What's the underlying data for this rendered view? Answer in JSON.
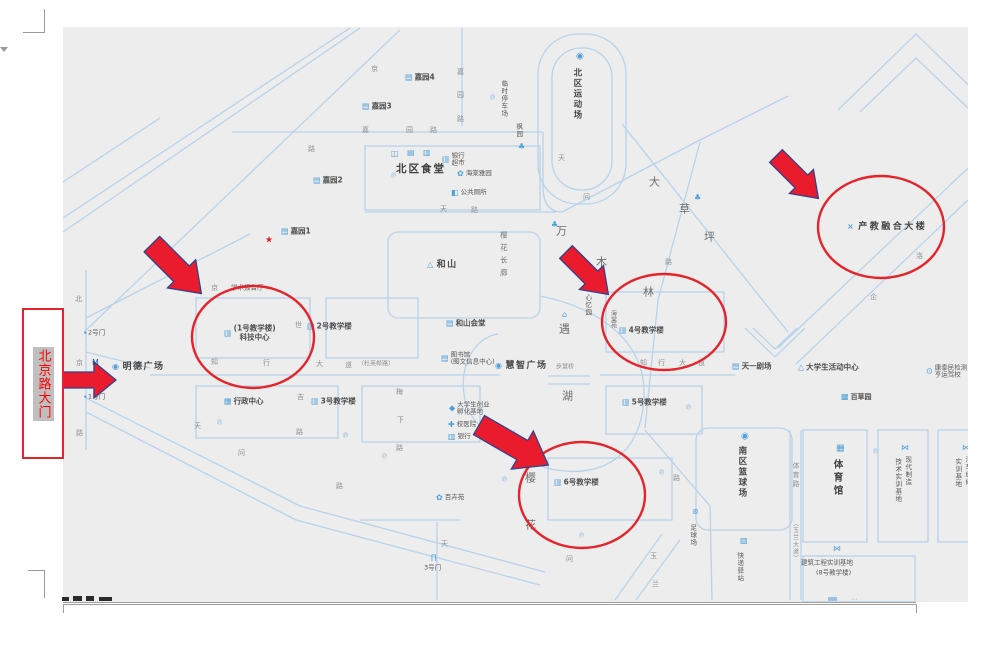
{
  "gate_box": {
    "text": "北京路大门",
    "text_color": "#ff0000",
    "border_color": "#e3242b",
    "highlight_color": "#bfbfbf"
  },
  "map": {
    "background": "#ededed",
    "road_color": "#b7d3ea",
    "icon_color": "#4fa0d9",
    "annotation_color": "#e5232b",
    "arrow_fill": "#ea1b2d",
    "arrow_stroke": "#334189",
    "labels": [
      {
        "t": "嘉园4",
        "x": 405,
        "y": 78,
        "k": "b",
        "i": "▤",
        "n": "jiayuan4-label"
      },
      {
        "t": "嘉园3",
        "x": 362,
        "y": 107,
        "k": "b",
        "i": "▤",
        "n": "jiayuan3-label"
      },
      {
        "t": "嘉园2",
        "x": 313,
        "y": 181,
        "k": "b",
        "i": "▤",
        "n": "jiayuan2-label"
      },
      {
        "t": "嘉园1",
        "x": 281,
        "y": 232,
        "k": "b",
        "i": "▤",
        "n": "jiayuan1-label"
      },
      {
        "i": "★",
        "x": 265,
        "y": 241,
        "s": 9,
        "ic": "#e02020",
        "n": "star-icon"
      },
      {
        "t": "北区食堂",
        "x": 396,
        "y": 169,
        "k": "bb",
        "n": "north-canteen-label"
      },
      {
        "i": "◫",
        "x": 391,
        "y": 154,
        "n": "canteen-icon"
      },
      {
        "i": "▤",
        "x": 407,
        "y": 153,
        "n": "canteen-icon"
      },
      {
        "i": "▥",
        "x": 423,
        "y": 153,
        "n": "canteen-icon"
      },
      {
        "l": [
          "银行",
          "超市"
        ],
        "x": 442,
        "y": 160,
        "k": "s2",
        "i": "▥",
        "n": "bank-store-label"
      },
      {
        "t": "海棠雅园",
        "x": 457,
        "y": 174,
        "k": "t",
        "i": "✿",
        "n": "haitang-garden-label"
      },
      {
        "t": "公共厕所",
        "x": 451,
        "y": 193,
        "k": "t",
        "i": "◧",
        "n": "public-toilet-label"
      },
      {
        "i": "℗",
        "x": 390,
        "y": 176,
        "s": 7,
        "ic": "#87b9de",
        "n": "parking-icon"
      },
      {
        "i": "℗",
        "x": 489,
        "y": 98,
        "s": 7,
        "ic": "#87b9de",
        "n": "parking-icon"
      },
      {
        "t": "临时停车场",
        "x": 503,
        "y": 80,
        "k": "tv",
        "v": true,
        "n": "temp-parking-label"
      },
      {
        "t": "枫园",
        "x": 518,
        "y": 123,
        "k": "tv",
        "v": true,
        "n": "fengyuan-label"
      },
      {
        "i": "♣",
        "x": 518,
        "y": 147,
        "n": "garden-icon"
      },
      {
        "i": "◉",
        "x": 576,
        "y": 57,
        "s": 9,
        "n": "stadium-icon"
      },
      {
        "t": "北区运动场",
        "x": 576,
        "y": 68,
        "k": "bv",
        "v": true,
        "n": "north-sports-field-label"
      },
      {
        "t": "嘉",
        "x": 457,
        "y": 72,
        "k": "r"
      },
      {
        "t": "园",
        "x": 457,
        "y": 95,
        "k": "r"
      },
      {
        "t": "路",
        "x": 457,
        "y": 119,
        "k": "r"
      },
      {
        "t": "京",
        "x": 371,
        "y": 69,
        "k": "r"
      },
      {
        "t": "嘉",
        "x": 362,
        "y": 130,
        "k": "r"
      },
      {
        "t": "园",
        "x": 406,
        "y": 130,
        "k": "r"
      },
      {
        "t": "路",
        "x": 430,
        "y": 130,
        "k": "r"
      },
      {
        "t": "路",
        "x": 308,
        "y": 149,
        "k": "r"
      },
      {
        "t": "京",
        "x": 211,
        "y": 288,
        "k": "r"
      },
      {
        "t": "天",
        "x": 558,
        "y": 158,
        "k": "r"
      },
      {
        "t": "天",
        "x": 440,
        "y": 209,
        "k": "r"
      },
      {
        "t": "路",
        "x": 471,
        "y": 210,
        "k": "r"
      },
      {
        "t": "问",
        "x": 583,
        "y": 197,
        "k": "r"
      },
      {
        "t": "路",
        "x": 665,
        "y": 262,
        "k": "r"
      },
      {
        "t": "问",
        "x": 238,
        "y": 453,
        "k": "r"
      },
      {
        "t": "路",
        "x": 336,
        "y": 486,
        "k": "r"
      },
      {
        "t": "天",
        "x": 194,
        "y": 426,
        "k": "r"
      },
      {
        "t": "天",
        "x": 441,
        "y": 544,
        "k": "r"
      },
      {
        "t": "问",
        "x": 566,
        "y": 559,
        "k": "r"
      },
      {
        "t": "路",
        "x": 673,
        "y": 478,
        "k": "r"
      },
      {
        "t": "玉",
        "x": 650,
        "y": 556,
        "k": "r"
      },
      {
        "t": "兰",
        "x": 652,
        "y": 584,
        "k": "r"
      },
      {
        "t": "洛",
        "x": 916,
        "y": 256,
        "k": "r"
      },
      {
        "t": "企",
        "x": 870,
        "y": 297,
        "k": "r"
      },
      {
        "t": "吉",
        "x": 297,
        "y": 397,
        "k": "r"
      },
      {
        "t": "路",
        "x": 296,
        "y": 432,
        "k": "r"
      },
      {
        "t": "梅",
        "x": 396,
        "y": 392,
        "k": "r"
      },
      {
        "t": "下",
        "x": 397,
        "y": 420,
        "k": "r"
      },
      {
        "t": "路",
        "x": 396,
        "y": 448,
        "k": "r"
      },
      {
        "t": "世",
        "x": 295,
        "y": 325,
        "k": "r"
      },
      {
        "t": "北",
        "x": 75,
        "y": 299,
        "k": "r"
      },
      {
        "t": "京",
        "x": 76,
        "y": 363,
        "k": "r"
      },
      {
        "t": "路",
        "x": 76,
        "y": 433,
        "k": "r"
      },
      {
        "t": "知",
        "x": 211,
        "y": 362,
        "k": "r"
      },
      {
        "t": "行",
        "x": 263,
        "y": 363,
        "k": "r"
      },
      {
        "t": "大",
        "x": 316,
        "y": 364,
        "k": "r"
      },
      {
        "t": "道",
        "x": 345,
        "y": 365,
        "k": "r"
      },
      {
        "t": "（杜英桦路）",
        "x": 358,
        "y": 365,
        "k": "rt",
        "n": "road-name-bracket"
      },
      {
        "t": "知",
        "x": 640,
        "y": 363,
        "k": "r"
      },
      {
        "t": "行",
        "x": 658,
        "y": 363,
        "k": "r"
      },
      {
        "t": "大",
        "x": 679,
        "y": 363,
        "k": "r"
      },
      {
        "t": "道",
        "x": 698,
        "y": 363,
        "k": "r"
      },
      {
        "t": "大",
        "x": 649,
        "y": 183,
        "k": "a"
      },
      {
        "t": "草",
        "x": 679,
        "y": 210,
        "k": "a"
      },
      {
        "t": "坪",
        "x": 704,
        "y": 238,
        "k": "a"
      },
      {
        "i": "♣",
        "x": 694,
        "y": 198,
        "n": "tree-icon"
      },
      {
        "t": "万",
        "x": 556,
        "y": 232,
        "k": "a"
      },
      {
        "t": "木",
        "x": 596,
        "y": 263,
        "k": "a"
      },
      {
        "t": "林",
        "x": 643,
        "y": 293,
        "k": "a"
      },
      {
        "i": "♣",
        "x": 551,
        "y": 225,
        "n": "tree-icon"
      },
      {
        "t": "遇",
        "x": 559,
        "y": 330,
        "k": "a"
      },
      {
        "t": "湖",
        "x": 562,
        "y": 397,
        "k": "a"
      },
      {
        "i": "⌂",
        "x": 562,
        "y": 315,
        "n": "pavilion-icon"
      },
      {
        "t": "樱",
        "x": 525,
        "y": 479,
        "k": "a"
      },
      {
        "t": "花",
        "x": 525,
        "y": 526,
        "k": "a"
      },
      {
        "i": "✿",
        "x": 526,
        "y": 456,
        "n": "flower-icon"
      },
      {
        "t": "樱花长廊",
        "x": 503,
        "y": 231,
        "k": "av",
        "v": true,
        "n": "cherry-corridor-label"
      },
      {
        "t": "心忆园",
        "x": 587,
        "y": 294,
        "k": "tv",
        "v": true,
        "n": "xinyi-garden-label"
      },
      {
        "t": "海棠苑",
        "x": 612,
        "y": 310,
        "k": "tv6",
        "v": true,
        "n": "haitang-court-label"
      },
      {
        "t": "学术报告厅",
        "x": 231,
        "y": 288,
        "k": "t",
        "n": "lecture-hall-label"
      },
      {
        "l": [
          "(1号教学楼)",
          "科技中心"
        ],
        "x": 224,
        "y": 333,
        "k": "b2",
        "i": "▥",
        "n": "building1-scitech-label"
      },
      {
        "t": "2号教学楼",
        "x": 307,
        "y": 327,
        "k": "b",
        "i": "▥",
        "n": "building2-label"
      },
      {
        "t": "和山",
        "x": 427,
        "y": 265,
        "k": "b9",
        "i": "△",
        "n": "heshan-label"
      },
      {
        "t": "和山会堂",
        "x": 446,
        "y": 324,
        "k": "b",
        "i": "▤",
        "n": "heshan-hall-label"
      },
      {
        "l": [
          "图书馆",
          "(图文信息中心)"
        ],
        "x": 441,
        "y": 359,
        "k": "s2",
        "i": "▤",
        "n": "library-label"
      },
      {
        "t": "慧智广场",
        "x": 495,
        "y": 366,
        "k": "b9",
        "i": "◉",
        "n": "huizhi-square-label"
      },
      {
        "t": "步慧桥",
        "x": 556,
        "y": 368,
        "k": "rt",
        "n": "bridge-label"
      },
      {
        "l": [
          "大学生创业",
          "孵化基地"
        ],
        "x": 449,
        "y": 409,
        "k": "s2",
        "i": "◆",
        "n": "incubator-label"
      },
      {
        "t": "校医院",
        "x": 448,
        "y": 425,
        "k": "t",
        "i": "✚",
        "n": "hospital-label"
      },
      {
        "t": "银行",
        "x": 448,
        "y": 437,
        "k": "t",
        "i": "▥",
        "n": "bank-label"
      },
      {
        "t": "百卉苑",
        "x": 436,
        "y": 498,
        "k": "t",
        "i": "✿",
        "n": "baihui-garden-label"
      },
      {
        "t": "行政中心",
        "x": 224,
        "y": 402,
        "k": "b",
        "i": "▦",
        "n": "admin-center-label"
      },
      {
        "t": "3号教学楼",
        "x": 311,
        "y": 402,
        "k": "b",
        "i": "▥",
        "n": "building3-label"
      },
      {
        "i": "℗",
        "x": 216,
        "y": 423,
        "s": 7,
        "ic": "#87b9de",
        "n": "parking-icon"
      },
      {
        "i": "℗",
        "x": 342,
        "y": 436,
        "s": 7,
        "ic": "#87b9de",
        "n": "parking-icon"
      },
      {
        "i": "℗",
        "x": 381,
        "y": 457,
        "s": 7,
        "ic": "#87b9de",
        "n": "parking-icon"
      },
      {
        "t": "明德广场",
        "x": 112,
        "y": 367,
        "k": "b9",
        "i": "◉",
        "n": "mingde-square-label"
      },
      {
        "i": "M",
        "x": 92,
        "y": 363,
        "s": 8,
        "ic": "#2563a8",
        "n": "landmark-m-icon"
      },
      {
        "i": "●",
        "x": 84,
        "y": 333,
        "s": 3,
        "n": "dot-icon"
      },
      {
        "t": "2号门",
        "x": 88,
        "y": 333,
        "k": "t",
        "n": "gate2-label"
      },
      {
        "i": "●",
        "x": 84,
        "y": 397,
        "s": 3,
        "n": "dot-icon"
      },
      {
        "t": "1号门",
        "x": 88,
        "y": 397,
        "k": "t",
        "n": "gate1-label"
      },
      {
        "i": "∏",
        "x": 431,
        "y": 558,
        "s": 7,
        "n": "gate-icon"
      },
      {
        "t": "3号门",
        "x": 424,
        "y": 568,
        "k": "t",
        "n": "gate3-label"
      },
      {
        "t": "4号教学楼",
        "x": 619,
        "y": 331,
        "k": "b",
        "i": "▥",
        "n": "building4-label"
      },
      {
        "t": "5号教学楼",
        "x": 622,
        "y": 403,
        "k": "b",
        "i": "▥",
        "n": "building5-label"
      },
      {
        "i": "℗",
        "x": 685,
        "y": 408,
        "s": 7,
        "ic": "#87b9de",
        "n": "parking-icon"
      },
      {
        "t": "6号教学楼",
        "x": 554,
        "y": 483,
        "k": "b",
        "i": "▥",
        "n": "building6-label"
      },
      {
        "i": "℗",
        "x": 501,
        "y": 480,
        "s": 7,
        "ic": "#87b9de",
        "n": "parking-icon"
      },
      {
        "i": "℗",
        "x": 578,
        "y": 536,
        "s": 7,
        "ic": "#87b9de",
        "n": "parking-icon"
      },
      {
        "i": "℗",
        "x": 658,
        "y": 473,
        "s": 7,
        "ic": "#87b9de",
        "n": "parking-icon"
      },
      {
        "i": "℗",
        "x": 872,
        "y": 452,
        "s": 7,
        "ic": "#87b9de",
        "n": "parking-icon"
      },
      {
        "t": "天一剧场",
        "x": 732,
        "y": 367,
        "k": "b",
        "i": "▤",
        "n": "tianyi-theater-label"
      },
      {
        "t": "大学生活动中心",
        "x": 798,
        "y": 368,
        "k": "b",
        "i": "△",
        "n": "student-activity-center-label"
      },
      {
        "t": "百草园",
        "x": 841,
        "y": 397,
        "k": "b7",
        "i": "▩",
        "n": "baicao-garden-label"
      },
      {
        "l": [
          "康泰民检测",
          "亨运驾校"
        ],
        "x": 926,
        "y": 372,
        "k": "s2",
        "i": "⊙",
        "n": "driving-school-label"
      },
      {
        "i": "◉",
        "x": 741,
        "y": 437,
        "s": 9,
        "n": "basketball-icon"
      },
      {
        "t": "南区篮球场",
        "x": 741,
        "y": 446,
        "k": "bv",
        "v": true,
        "n": "south-basketball-label"
      },
      {
        "i": "⊛",
        "x": 692,
        "y": 512,
        "s": 8,
        "n": "soccer-icon"
      },
      {
        "t": "足球场",
        "x": 692,
        "y": 524,
        "k": "tv",
        "v": true,
        "n": "soccer-field-label"
      },
      {
        "i": "▧",
        "x": 740,
        "y": 541,
        "n": "express-icon"
      },
      {
        "t": "快递驿站",
        "x": 739,
        "y": 552,
        "k": "tv",
        "v": true,
        "n": "express-station-label"
      },
      {
        "t": "体育路",
        "x": 796,
        "y": 462,
        "k": "rv",
        "v": true,
        "n": "sports-road-label"
      },
      {
        "t": "（玉兰大道）",
        "x": 794,
        "y": 520,
        "k": "rv6",
        "v": true,
        "n": "yulan-avenue-label"
      },
      {
        "i": "▦",
        "x": 836,
        "y": 449,
        "s": 9,
        "n": "gym-icon"
      },
      {
        "t": "体育馆",
        "x": 836,
        "y": 459,
        "k": "b10v",
        "v": true,
        "n": "gymnasium-label"
      },
      {
        "i": "⋈",
        "x": 901,
        "y": 448,
        "n": "training-base-icon"
      },
      {
        "t": "现代制造",
        "x": 907,
        "y": 456,
        "k": "tv",
        "v": true,
        "n": "modern-mfg-label"
      },
      {
        "t": "技术实训基地",
        "x": 897,
        "y": 458,
        "k": "tv",
        "v": true,
        "n": "modern-mfg-label2"
      },
      {
        "i": "⋈",
        "x": 962,
        "y": 448,
        "n": "training-base-icon"
      },
      {
        "t": "汽车维修",
        "x": 967,
        "y": 456,
        "k": "tv",
        "v": true,
        "n": "auto-repair-label"
      },
      {
        "t": "实训基地",
        "x": 957,
        "y": 458,
        "k": "tv",
        "v": true,
        "n": "auto-repair-label2"
      },
      {
        "i": "⋈",
        "x": 833,
        "y": 549,
        "n": "training-base-icon"
      },
      {
        "t": "建筑工程实训基地",
        "x": 801,
        "y": 563,
        "k": "t",
        "n": "construction-base-label"
      },
      {
        "t": "(8号教学楼)",
        "x": 816,
        "y": 573,
        "k": "t",
        "n": "building8-label"
      },
      {
        "t": "产教融合大楼",
        "x": 847,
        "y": 227,
        "k": "b95",
        "i": "×",
        "n": "industry-education-building-label"
      }
    ]
  },
  "annotations": {
    "circles": [
      {
        "cx": 253,
        "cy": 337,
        "rx": 61,
        "ry": 51
      },
      {
        "cx": 664,
        "cy": 322,
        "rx": 62,
        "ry": 48
      },
      {
        "cx": 881,
        "cy": 227,
        "rx": 63,
        "ry": 51
      },
      {
        "cx": 582,
        "cy": 495,
        "rx": 63,
        "ry": 53
      }
    ],
    "arrows": [
      {
        "pts": "0,8 36,8 36,0 60,17 36,34 36,26 0,26",
        "tf": "translate(788,144) rotate(45)"
      },
      {
        "pts": "0,9 42,9 42,0 70,20 42,40 42,31 0,31",
        "tf": "translate(166,230) rotate(45)"
      },
      {
        "pts": "0,10 32,10 32,0 54,18 32,36 32,26 0,26",
        "tf": "translate(62,362)"
      },
      {
        "pts": "0,8 36,8 36,0 60,17 36,34 36,26 0,26",
        "tf": "translate(578,240) rotate(45)"
      },
      {
        "pts": "0,11 50,11 50,0 80,22 50,44 50,33 0,33",
        "tf": "translate(490,406) rotate(30)"
      }
    ]
  }
}
